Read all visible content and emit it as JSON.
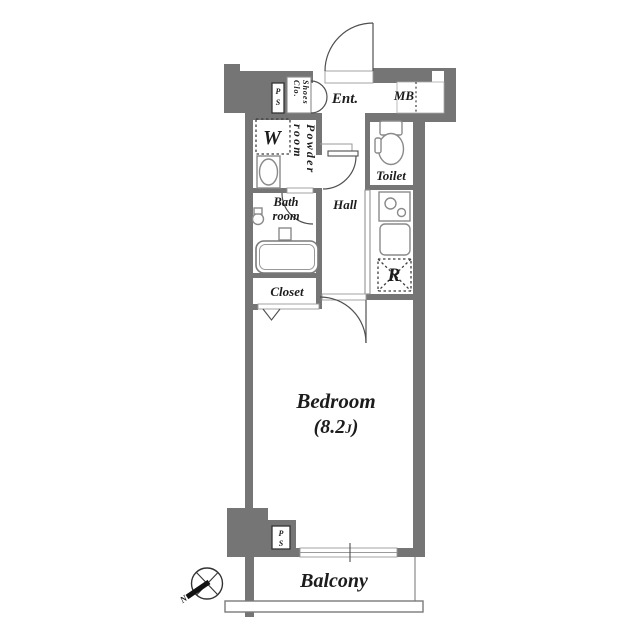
{
  "floor_plan": {
    "labels": {
      "entrance": "Ent.",
      "meter_box": "MB",
      "toilet": "Toilet",
      "hall": "Hall",
      "powder_line1": "Powder",
      "powder_line2": "room",
      "shoes_line1": "Shoes",
      "shoes_line2": "Clo.",
      "bath_line1": "Bath",
      "bath_line2": "room",
      "closet": "Closet",
      "bedroom": "Bedroom",
      "bedroom_size_open": "(8.2",
      "bedroom_size_unit": "J",
      "bedroom_size_close": ")",
      "balcony": "Balcony",
      "washer": "W",
      "refrigerator": "R",
      "ps_top_p": "P",
      "ps_top_s": "S",
      "ps_bottom_p": "P",
      "ps_bottom_s": "S",
      "compass_north": "N"
    },
    "colors": {
      "wall": "#757575",
      "fixture_line": "#8a8a8a",
      "door_line": "#4f4f4f",
      "dotted_line": "#3f3f3f",
      "text": "#1c1c1c",
      "background": "#ffffff"
    }
  }
}
